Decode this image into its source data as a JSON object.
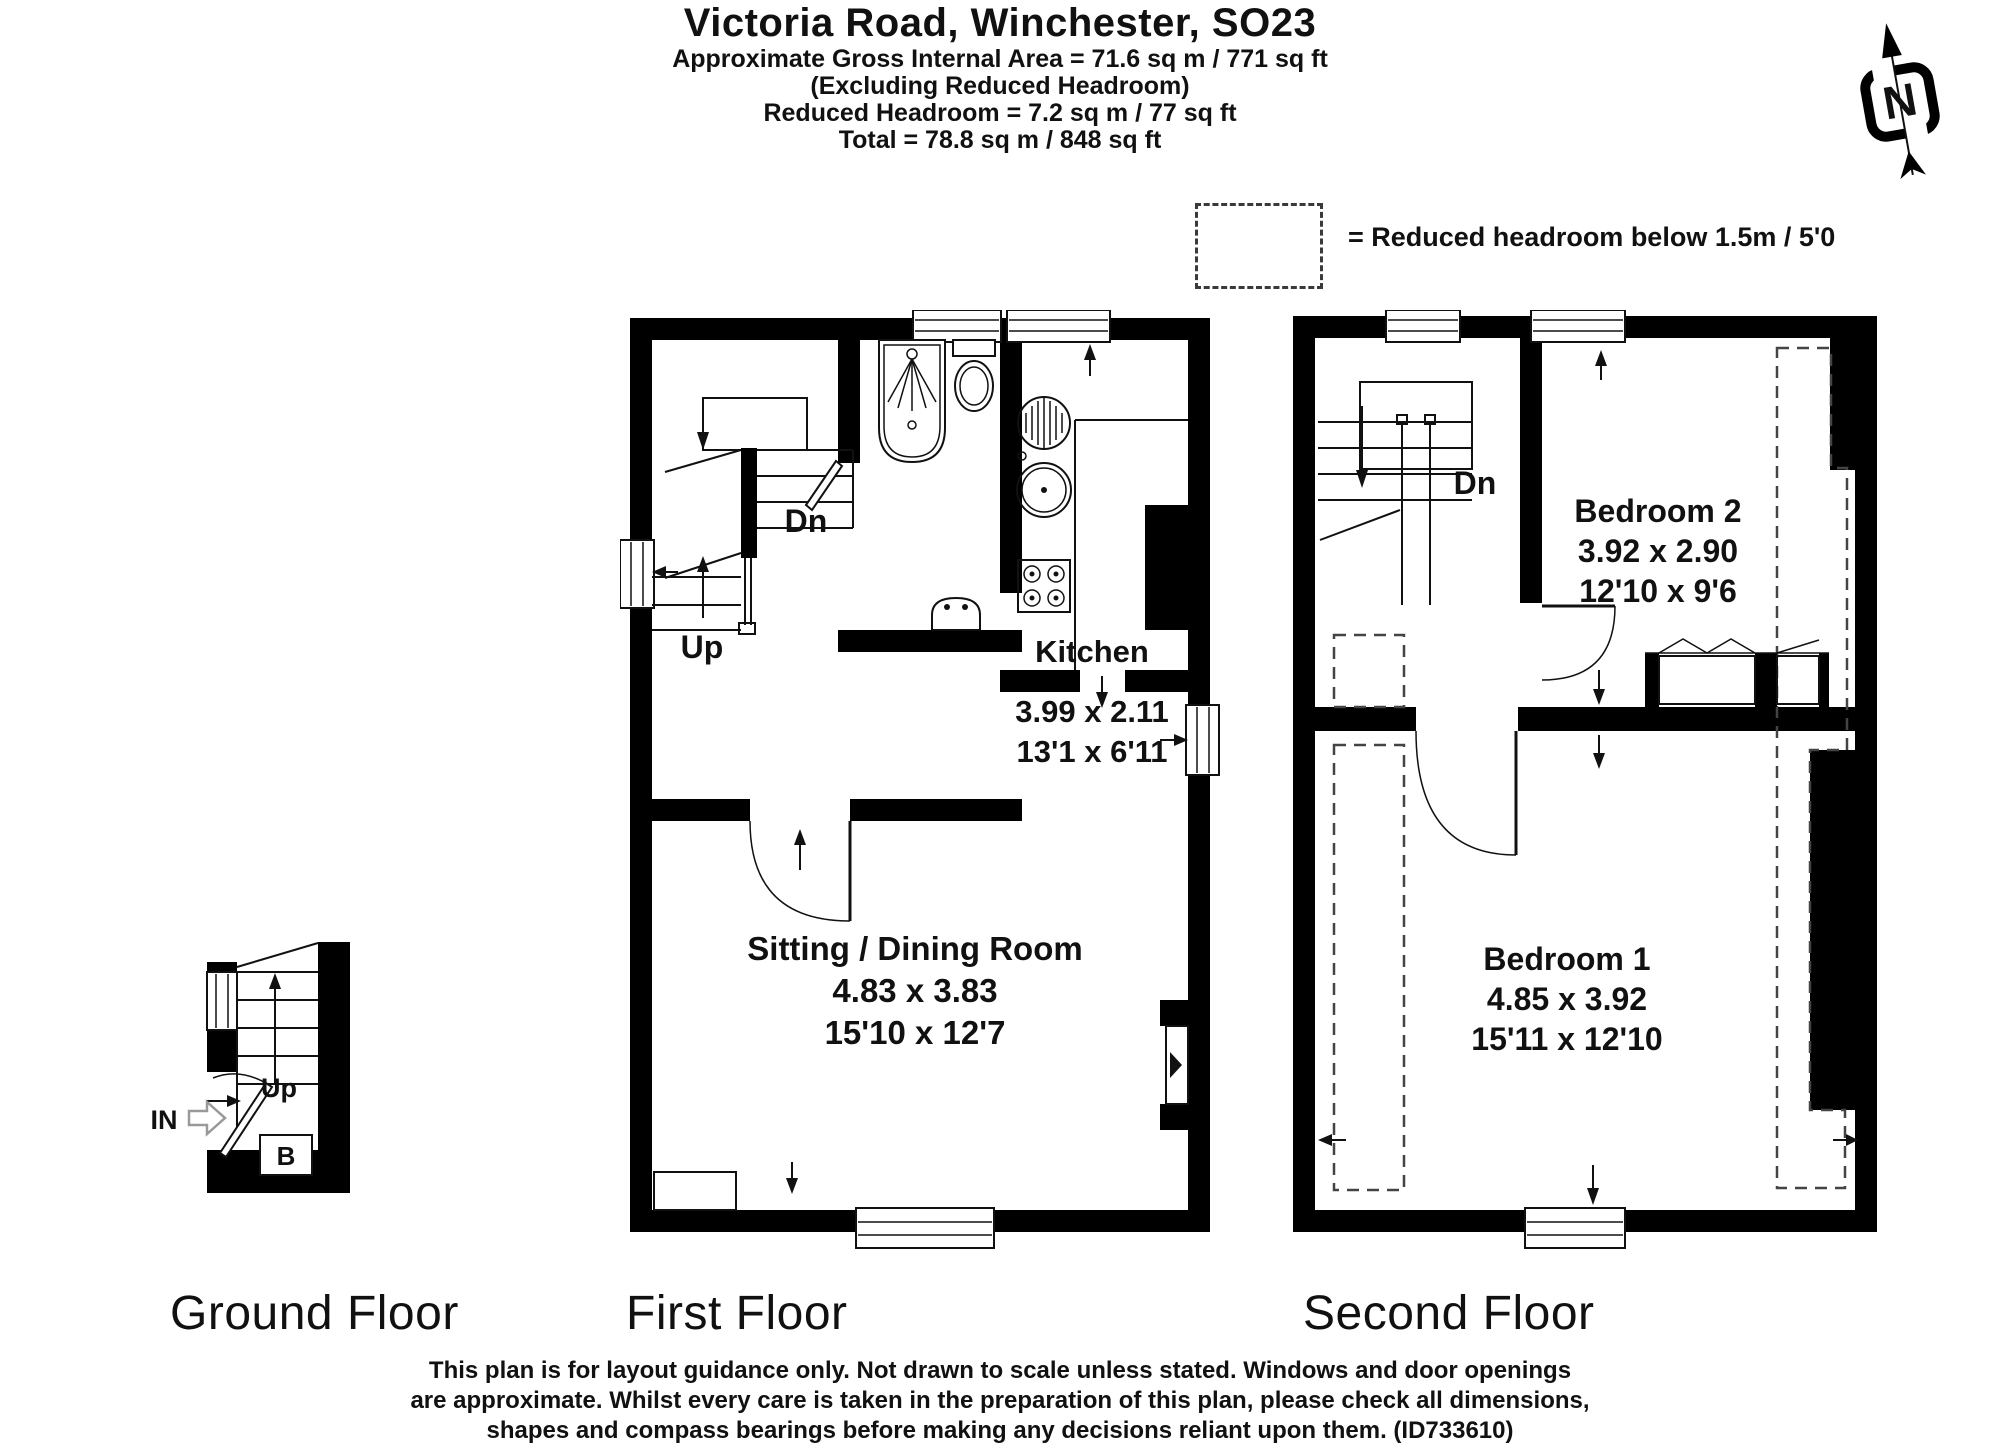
{
  "header": {
    "title": "Victoria Road, Winchester, SO23",
    "subtitle1": "Approximate Gross Internal Area = 71.6 sq m / 771 sq ft",
    "subtitle2": "(Excluding Reduced Headroom)",
    "subtitle3": "Reduced Headroom = 7.2 sq m / 77 sq ft",
    "subtitle4": "Total = 78.8 sq m / 848 sq ft"
  },
  "legend": {
    "label": "= Reduced headroom below 1.5m / 5'0"
  },
  "compass": {
    "letter": "N"
  },
  "floors": {
    "ground": {
      "label": "Ground Floor",
      "up": "Up",
      "entrance": "IN",
      "boiler": "B"
    },
    "first": {
      "label": "First Floor",
      "stairs": {
        "down": "Dn",
        "up": "Up"
      },
      "kitchen": {
        "name": "Kitchen",
        "metric": "3.99 x 2.11",
        "imperial": "13'1 x 6'11"
      },
      "sitting": {
        "name": "Sitting / Dining Room",
        "metric": "4.83 x 3.83",
        "imperial": "15'10 x 12'7"
      }
    },
    "second": {
      "label": "Second Floor",
      "stairs": {
        "down": "Dn"
      },
      "bedroom2": {
        "name": "Bedroom 2",
        "metric": "3.92 x 2.90",
        "imperial": "12'10 x 9'6"
      },
      "bedroom1": {
        "name": "Bedroom 1",
        "metric": "4.85 x 3.92",
        "imperial": "15'11 x 12'10"
      }
    }
  },
  "footer": {
    "line1": "This plan is for layout guidance only. Not drawn to scale unless stated. Windows and door openings",
    "line2": "are approximate. Whilst every care is taken in the preparation of this plan, please check all dimensions,",
    "line3": "shapes and compass bearings before making any decisions reliant upon them. (ID733610)",
    "plan_id": "ID733610"
  },
  "colors": {
    "wall": "#000000",
    "background": "#ffffff",
    "dashed": "#444444"
  }
}
